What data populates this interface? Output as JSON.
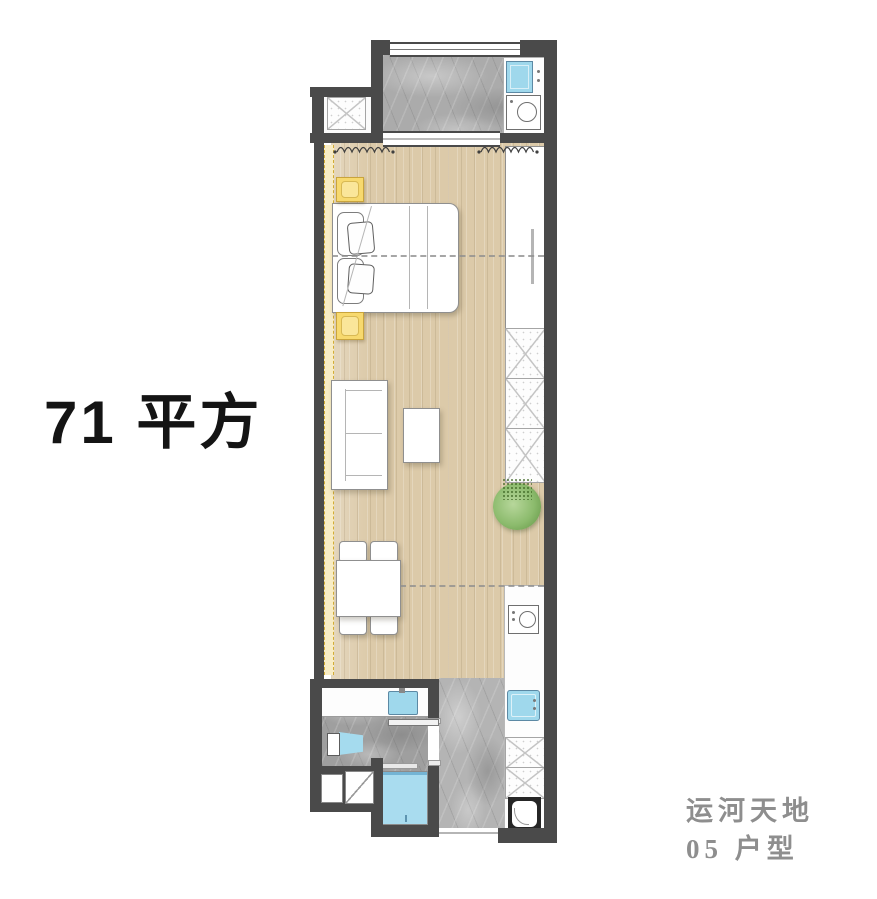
{
  "page": {
    "width": 877,
    "height": 899,
    "background": "#ffffff"
  },
  "title": {
    "area_label": "71 平方"
  },
  "footer": {
    "project_name": "运河天地",
    "unit_label": "05 户型"
  },
  "palette": {
    "wall": "#4a4a4a",
    "wood_floor": "#dccaa9",
    "marble_floor": "#ababab",
    "water_blue": "#9fd8ec",
    "plant_green": "#82b465",
    "cabinet_yellow": "#f7d96e",
    "footer_text": "#8e8e8e",
    "title_text": "#141414"
  },
  "floorplan": {
    "rooms": [
      {
        "name": "laundry-balcony",
        "floor": "gray-marble"
      },
      {
        "name": "living-bedroom",
        "floor": "wood"
      },
      {
        "name": "kitchen-hall",
        "floor": "gray-marble"
      },
      {
        "name": "bathroom",
        "floor": "gray-marble"
      }
    ],
    "fixtures": [
      "laundry-sink",
      "washing-machine",
      "ac-platform",
      "double-bed",
      "nightstand-top",
      "nightstand-bottom",
      "wardrobe",
      "storage-cabinets",
      "potted-plant",
      "sofa",
      "coffee-table",
      "dining-table",
      "dining-chairs",
      "kitchen-counter",
      "cooktop",
      "kitchen-sink",
      "kitchen-cabinets",
      "bathroom-vanity",
      "vanity-sink",
      "toilet",
      "shower",
      "sliding-door",
      "entry-door"
    ]
  }
}
